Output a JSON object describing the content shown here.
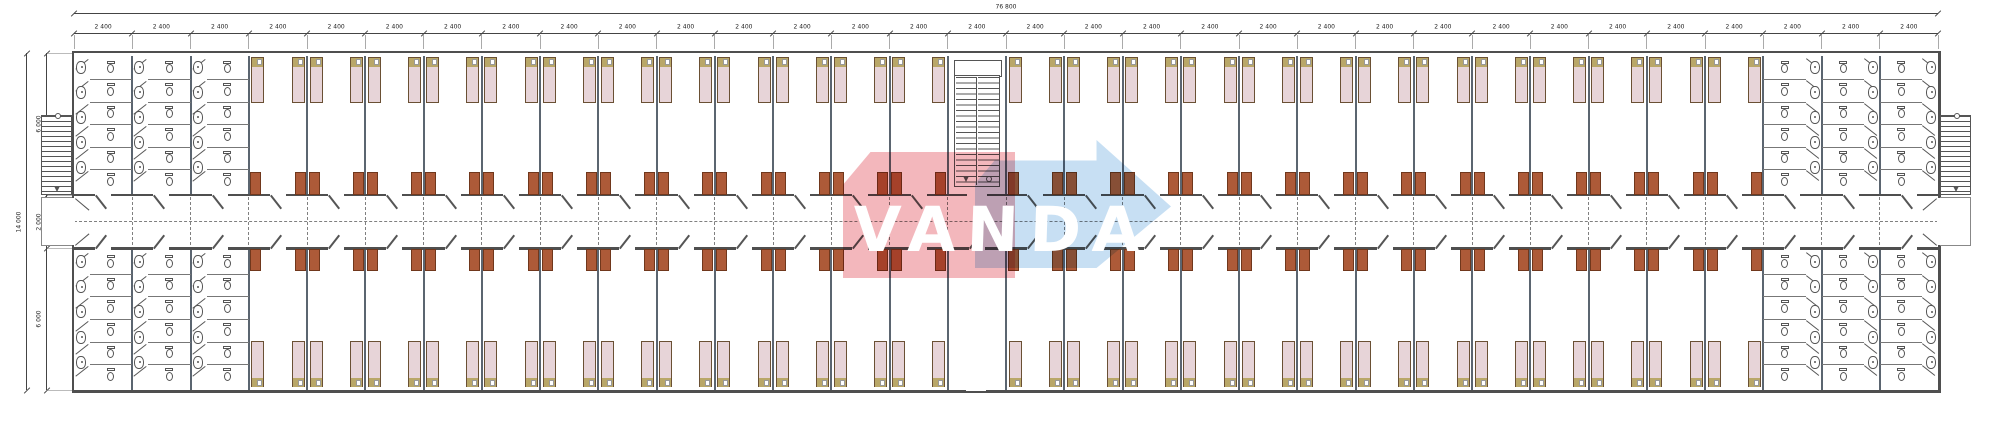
{
  "drawing": {
    "kind": "modular dormitory floor plan",
    "watermark": {
      "text": "VANDA"
    }
  },
  "dimensions": {
    "total_width_label": "76 800",
    "module_label": "2 400",
    "module_count": 32,
    "total_height_label": "14 000",
    "height_segments": [
      "6 000",
      "2 000",
      "6 000"
    ]
  },
  "plan": {
    "modules_total": 32,
    "left_sanitary_modules": 3,
    "right_sanitary_modules": 3,
    "stair_module_index": 16,
    "beds_per_room": 2,
    "toilet_stalls_per_column": 6,
    "sinks_per_column": 5
  },
  "colors": {
    "wall": "#4f4f4f",
    "party_wall": "#5b6570",
    "bed_fill": "#e7d4d8",
    "bed_border": "#6a5034",
    "bed_headboard": "#b9a768",
    "wardrobe": "#ad5a38",
    "wardrobe_border": "#70371c",
    "fixture_outline": "#555555",
    "dash": "#808080",
    "dim_line": "#444444",
    "watermark_red": "#e2525e",
    "watermark_blue": "#8fbfe8",
    "watermark_text": "#ffffff"
  }
}
